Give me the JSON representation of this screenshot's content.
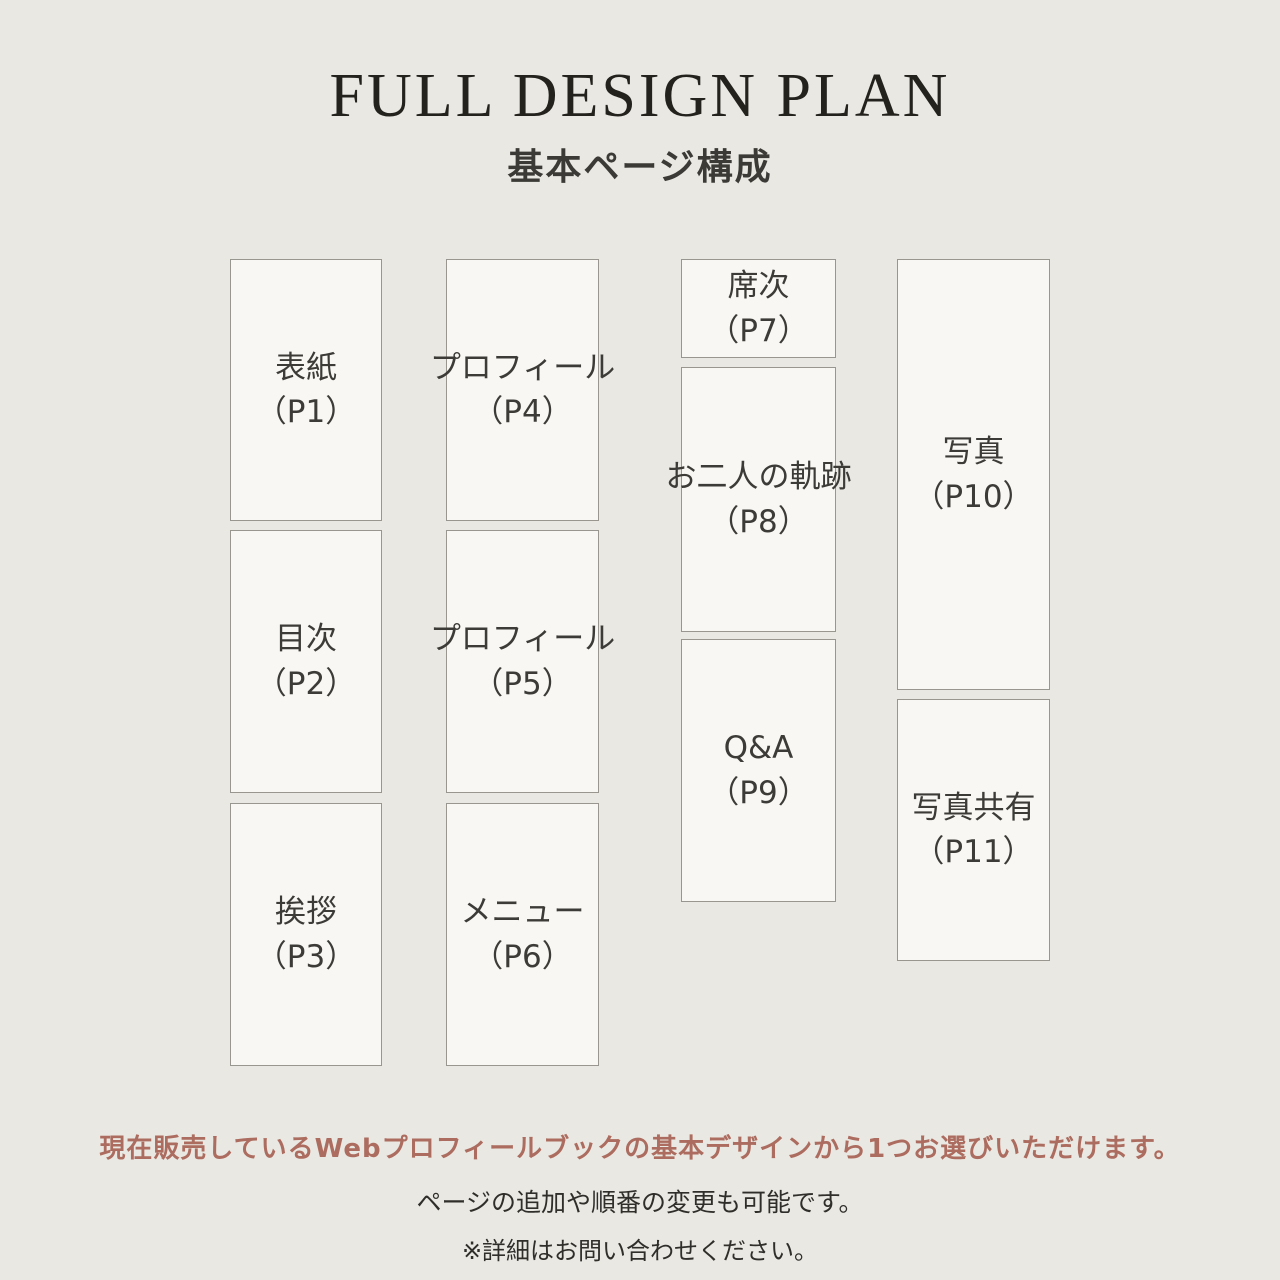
{
  "header": {
    "title": "FULL DESIGN PLAN",
    "subtitle": "基本ページ構成"
  },
  "cards": [
    {
      "id": "p1",
      "title": "表紙",
      "page": "（P1）"
    },
    {
      "id": "p2",
      "title": "目次",
      "page": "（P2）"
    },
    {
      "id": "p3",
      "title": "挨拶",
      "page": "（P3）"
    },
    {
      "id": "p4",
      "title": "プロフィール",
      "page": "（P4）"
    },
    {
      "id": "p5",
      "title": "プロフィール",
      "page": "（P5）"
    },
    {
      "id": "p6",
      "title": "メニュー",
      "page": "（P6）"
    },
    {
      "id": "p7",
      "title": "席次",
      "page": "（P7）"
    },
    {
      "id": "p8",
      "title": "お二人の軌跡",
      "page": "（P8）"
    },
    {
      "id": "p9",
      "title": "Q&A",
      "page": "（P9）"
    },
    {
      "id": "p10",
      "title": "写真",
      "page": "（P10）"
    },
    {
      "id": "p11",
      "title": "写真共有",
      "page": "（P11）"
    }
  ],
  "footer": {
    "line1": "現在販売しているWebプロフィールブックの基本デザインから1つお選びいただけます。",
    "line2": "ページの追加や順番の変更も可能です。",
    "line3": "※詳細はお問い合わせください。"
  },
  "colors": {
    "background": "#eae8e2",
    "card_background": "#f8f7f3",
    "card_border": "#98968f",
    "title_text": "#23221d",
    "card_text": "#3c3b37",
    "accent_text": "#ac6c5f",
    "footer_text": "#2f2e2b"
  }
}
